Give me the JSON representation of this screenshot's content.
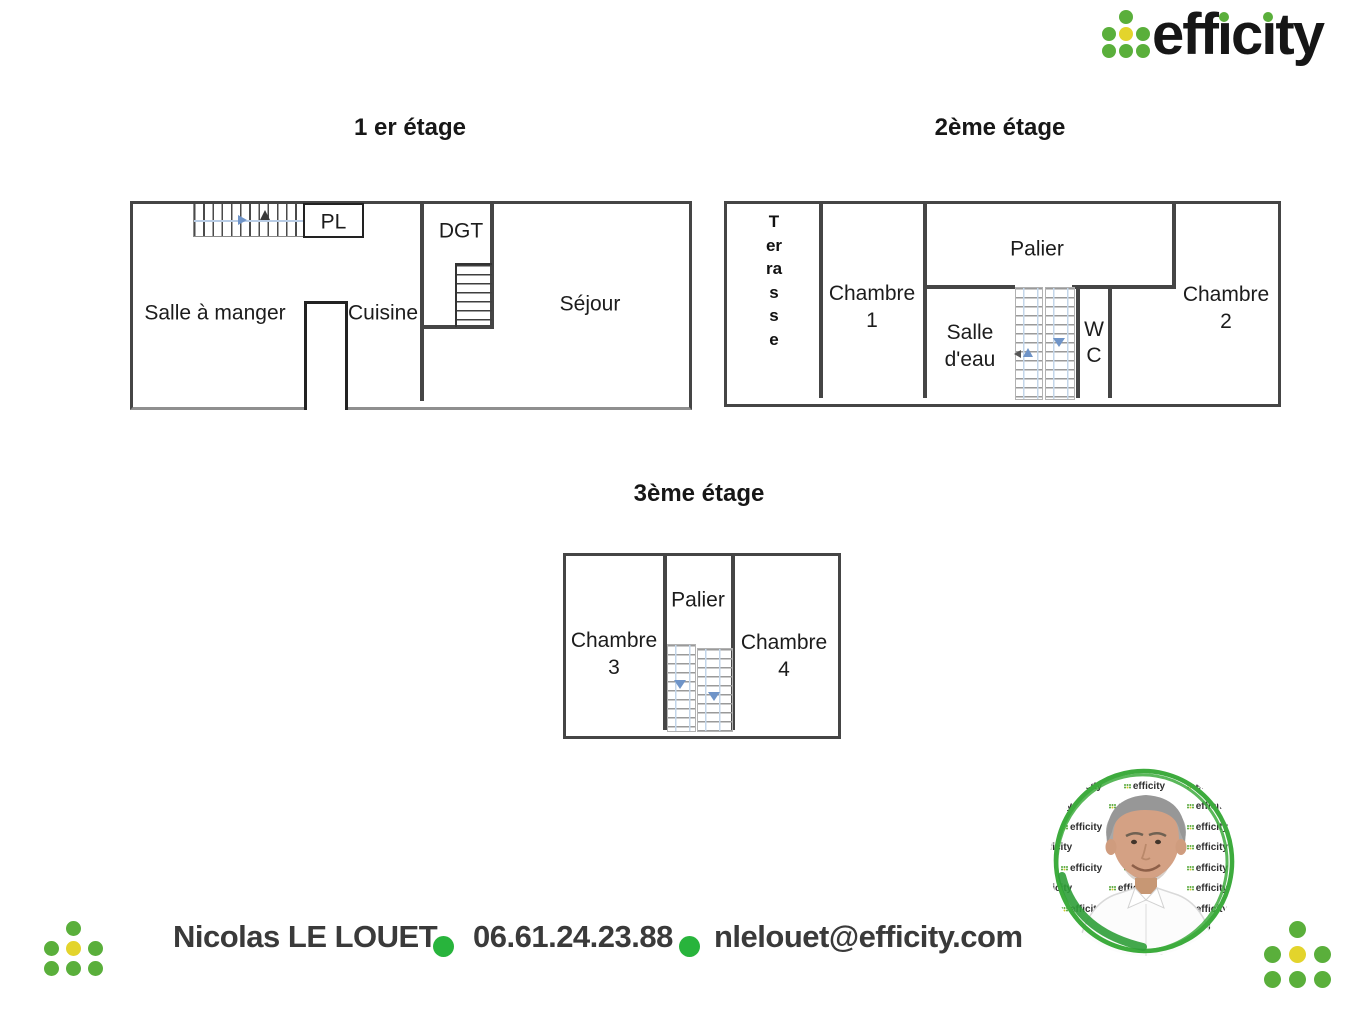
{
  "logo": {
    "parts": [
      "eff",
      "ı",
      "c",
      "ı",
      "ty"
    ]
  },
  "floor1": {
    "title": "1 er étage",
    "labels": {
      "dining": "Salle à manger",
      "kitchen": "Cuisine",
      "closet": "PL",
      "hall": "DGT",
      "living": "Séjour"
    }
  },
  "floor2": {
    "title": "2ème étage",
    "labels": {
      "terrace": "Terrasse",
      "bedroom1_line1": "Chambre",
      "bedroom1_line2": "1",
      "landing": "Palier",
      "shower_line1": "Salle",
      "shower_line2": "d'eau",
      "wc_line1": "W",
      "wc_line2": "C",
      "bedroom2_line1": "Chambre",
      "bedroom2_line2": "2"
    }
  },
  "floor3": {
    "title": "3ème étage",
    "labels": {
      "bedroom3_line1": "Chambre",
      "bedroom3_line2": "3",
      "landing": "Palier",
      "bedroom4_line1": "Chambre",
      "bedroom4_line2": "4"
    }
  },
  "contact": {
    "name": "Nicolas LE LOUET",
    "phone": "06.61.24.23.88",
    "email": "nlelouet@efficity.com"
  },
  "photo": {
    "watermark": "efficity"
  },
  "colors": {
    "wall": "#454545",
    "logo_green": "#5aaf3b",
    "logo_yellow": "#e3d42c",
    "bullet_green": "#28b43c",
    "stair_blue": "#6f94c8",
    "text_dark": "#3a3a3a"
  }
}
